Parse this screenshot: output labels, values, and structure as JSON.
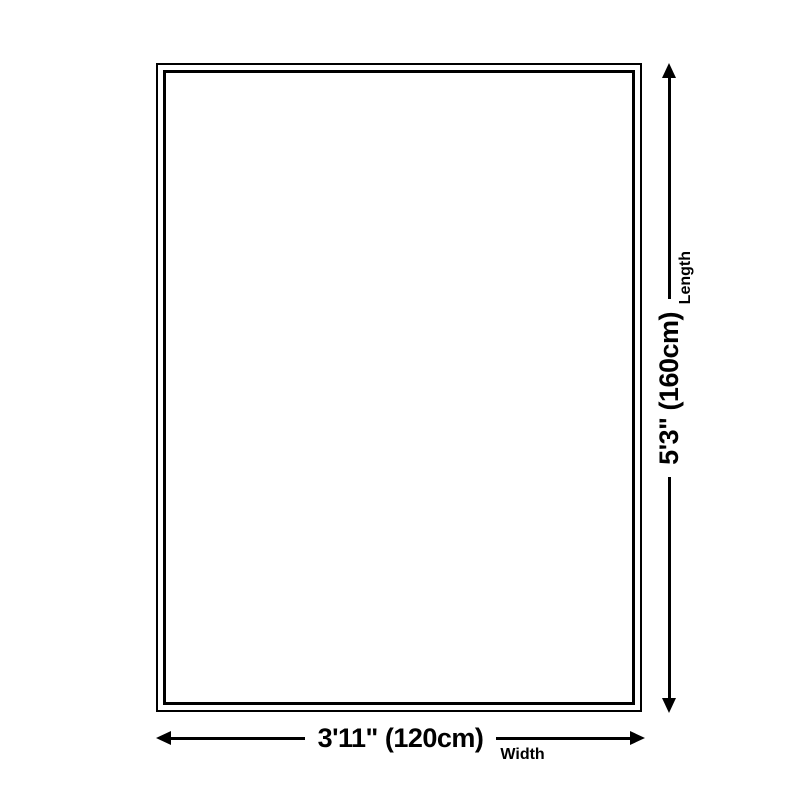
{
  "diagram": {
    "background_color": "#ffffff",
    "line_color": "#000000",
    "length": {
      "value": "5'3\" (160cm)",
      "label": "Length"
    },
    "width": {
      "value": "3'11\" (120cm)",
      "label": "Width"
    }
  }
}
